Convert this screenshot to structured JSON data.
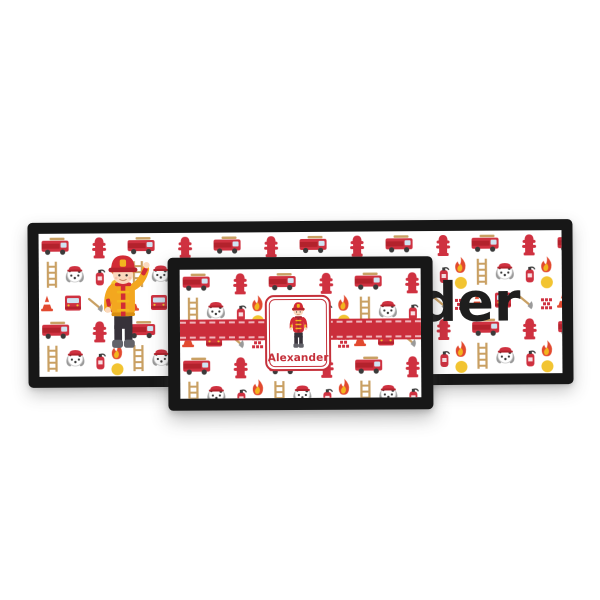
{
  "photo": {
    "background_color": "#ffffff",
    "theme": "firefighter-pattern",
    "pattern_icons": [
      "fire-truck-side",
      "fire-truck-front",
      "fire-hydrant",
      "dalmatian-dog",
      "ladder",
      "flame",
      "sun-dot",
      "traffic-cone",
      "fire-extinguisher",
      "axe",
      "alarm-emblem"
    ],
    "colors": {
      "frame_black": "#171717",
      "pattern_red": "#cf3140",
      "ribbon_red": "#cb2e3b",
      "accent_gold": "#f3a71f",
      "accent_yellow": "#f2b51e",
      "hair_orange": "#e08a3c",
      "skin": "#fbd9bd",
      "name_black": "#1e1e1e",
      "name_red": "#c5313b"
    }
  },
  "runner": {
    "name": "Alexander",
    "visible_name_part": "er"
  },
  "mat": {
    "name": "Alexander"
  }
}
